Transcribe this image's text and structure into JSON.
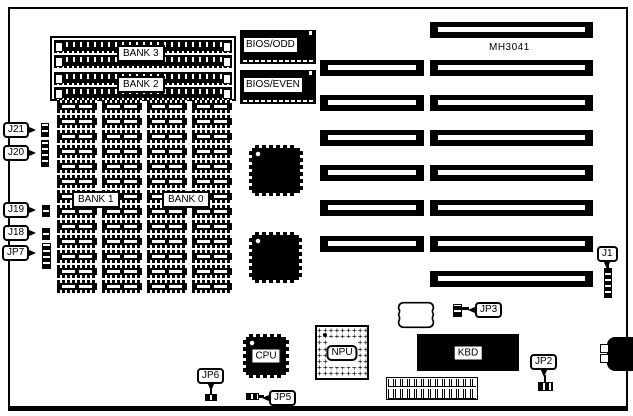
{
  "diagram": {
    "board_model": "MH3041",
    "memory": {
      "bank3_label": "BANK 3",
      "bank2_label": "BANK 2",
      "bank1_label": "BANK 1",
      "bank0_label": "BANK 0",
      "simm_socket_count": 4,
      "dip_grid": {
        "rows": 13,
        "columns": 4
      }
    },
    "bios": {
      "odd_label": "BIOS/ODD",
      "even_label": "BIOS/EVEN"
    },
    "chips": {
      "cpu_label": "CPU",
      "npu_label": "NPU",
      "kbd_label": "KBD"
    },
    "jumpers": {
      "j21": "J21",
      "j20": "J20",
      "j19": "J19",
      "j18": "J18",
      "jp7": "JP7",
      "jp6": "JP6",
      "jp5": "JP5",
      "jp3": "JP3",
      "jp2": "JP2",
      "j1": "J1"
    },
    "expansion_slots": {
      "count": 8,
      "types": [
        "8-bit",
        "16-bit",
        "16-bit",
        "16-bit",
        "16-bit",
        "16-bit",
        "16-bit",
        "8-bit"
      ]
    },
    "colors": {
      "ink": "#000000",
      "background": "#ffffff"
    }
  }
}
